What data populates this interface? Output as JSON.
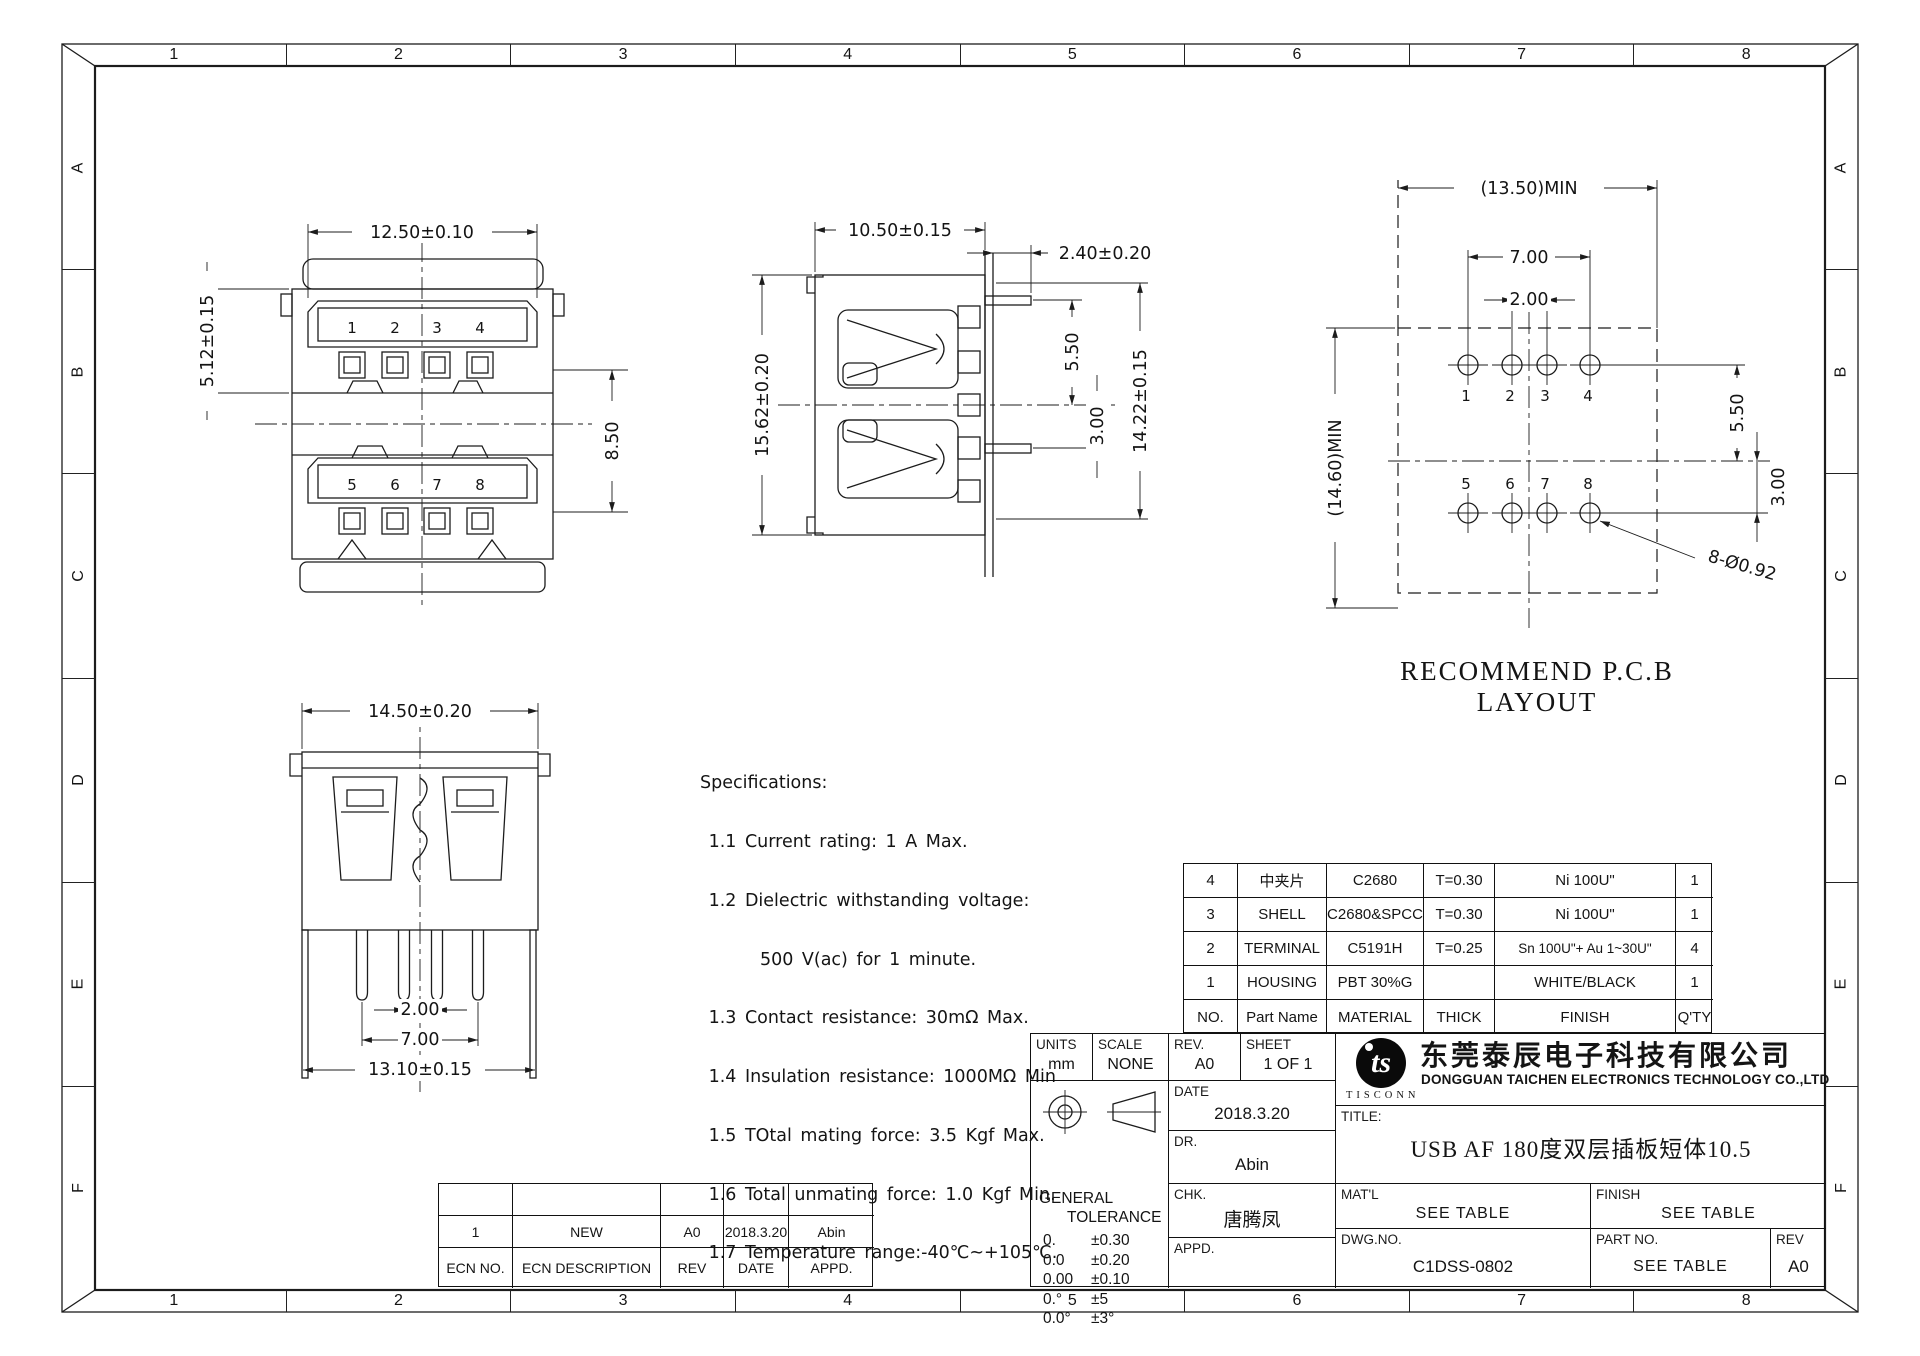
{
  "sheet": {
    "zones": {
      "cols": [
        "1",
        "2",
        "3",
        "4",
        "5",
        "6",
        "7",
        "8"
      ],
      "rows": [
        "A",
        "B",
        "C",
        "D",
        "E",
        "F"
      ]
    }
  },
  "views": {
    "front": {
      "dim_width": "12.50±0.10",
      "dim_left": "5.12±0.15",
      "dim_right": "8.50",
      "pins_top": [
        "1",
        "2",
        "3",
        "4"
      ],
      "pins_bottom": [
        "5",
        "6",
        "7",
        "8"
      ]
    },
    "side": {
      "dim_width": "10.50±0.15",
      "dim_tail": "2.40±0.20",
      "dim_height": "15.62±0.20",
      "dim_peg_top": "5.50",
      "dim_peg_bottom": "3.00",
      "dim_total": "14.22±0.15"
    },
    "rear": {
      "dim_width": "14.50±0.20",
      "dim_pin_inner": "2.00",
      "dim_pin_outer": "7.00",
      "dim_leg": "13.10±0.15"
    },
    "pcb": {
      "dim_width": "(13.50)MIN",
      "dim_height": "(14.60)MIN",
      "dim_row": "7.00",
      "dim_col": "2.00",
      "dim_upper": "5.50",
      "dim_lower": "3.00",
      "dim_hole": "8-Ø0.92",
      "caption": "RECOMMEND P.C.B LAYOUT",
      "holes_top": [
        "1",
        "2",
        "3",
        "4"
      ],
      "holes_bottom": [
        "5",
        "6",
        "7",
        "8"
      ]
    }
  },
  "specs": {
    "lines": [
      "Specifications:",
      " 1.1 Current rating: 1 A Max.",
      " 1.2 Dielectric withstanding voltage:",
      "       500 V(ac) for 1 minute.",
      " 1.3 Contact resistance: 30mΩ Max.",
      " 1.4 Insulation resistance: 1000MΩ Min",
      " 1.5 TOtal mating force: 3.5 Kgf Max.",
      " 1.6 Total unmating force: 1.0 Kgf Min.",
      " 1.7 Temperature range:-40℃~+105℃."
    ]
  },
  "bom": {
    "headers": [
      "NO.",
      "Part Name",
      "MATERIAL",
      "THICK",
      "FINISH",
      "Q'TY"
    ],
    "rows": [
      [
        "4",
        "中夹片",
        "C2680",
        "T=0.30",
        "Ni 100U\"",
        "1"
      ],
      [
        "3",
        "SHELL",
        "C2680&SPCC",
        "T=0.30",
        "Ni 100U\"",
        "1"
      ],
      [
        "2",
        "TERMINAL",
        "C5191H",
        "T=0.25",
        "Sn 100U\"+ Au 1~30U\"",
        "4"
      ],
      [
        "1",
        "HOUSING",
        "PBT 30%G",
        "",
        "WHITE/BLACK",
        "1"
      ]
    ]
  },
  "titleblock": {
    "units_label": "UNITS",
    "units_value": "mm",
    "scale_label": "SCALE",
    "scale_value": "NONE",
    "rev_label": "REV.",
    "rev_value": "A0",
    "sheet_label": "SHEET",
    "sheet_value": "1 OF 1",
    "date_label": "DATE",
    "date_value": "2018.3.20",
    "dr_label": "DR.",
    "dr_value": "Abin",
    "chk_label": "CHK.",
    "chk_value": "唐腾凤",
    "appd_label": "APPD.",
    "appd_value": "",
    "general_line1": "GENERAL",
    "general_line2": "TOLERANCE",
    "tolerances": [
      [
        "0.",
        "±0.30"
      ],
      [
        "0.0",
        "±0.20"
      ],
      [
        "0.00",
        "±0.10"
      ],
      [
        "0.°",
        "±5"
      ],
      [
        "0.0°",
        "±3°"
      ]
    ],
    "logo_text": "ts",
    "logo_sub": "TISCONN",
    "company_cn": "东莞泰辰电子科技有限公司",
    "company_en": "DONGGUAN TAICHEN ELECTRONICS TECHNOLOGY CO.,LTD",
    "title_label": "TITLE:",
    "title_value": "USB AF 180度双层插板短体10.5",
    "matl_label": "MAT'L",
    "matl_value": "SEE TABLE",
    "finish_label": "FINISH",
    "finish_value": "SEE TABLE",
    "dwg_label": "DWG.NO.",
    "dwg_value": "C1DSS-0802",
    "part_label": "PART NO.",
    "part_value": "SEE TABLE",
    "rev2_label": "REV",
    "rev2_value": "A0"
  },
  "ecn": {
    "headers": [
      "ECN NO.",
      "ECN DESCRIPTION",
      "REV",
      "DATE",
      "APPD."
    ],
    "row": [
      "1",
      "NEW",
      "A0",
      "2018.3.20",
      "Abin"
    ]
  }
}
